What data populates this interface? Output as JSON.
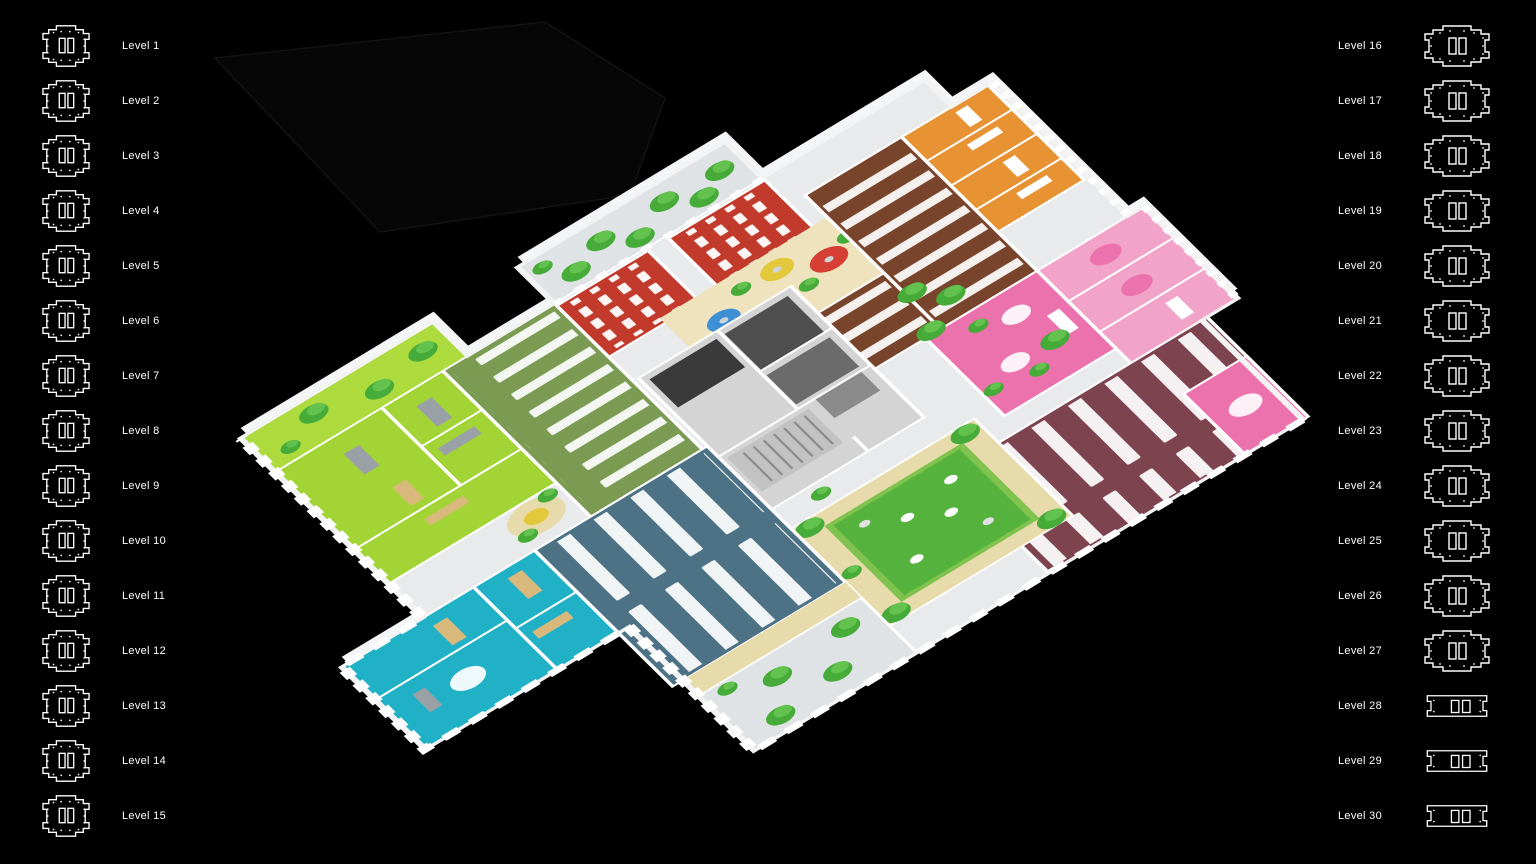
{
  "app": {
    "background": "#000000",
    "view": "3d-isometric-floorplan"
  },
  "sidebar_left": {
    "items": [
      {
        "label": "Level 1",
        "icon_variant": "octagon-a"
      },
      {
        "label": "Level 2",
        "icon_variant": "octagon-a"
      },
      {
        "label": "Level 3",
        "icon_variant": "octagon-a"
      },
      {
        "label": "Level 4",
        "icon_variant": "octagon-a"
      },
      {
        "label": "Level 5",
        "icon_variant": "octagon-a"
      },
      {
        "label": "Level 6",
        "icon_variant": "octagon-a"
      },
      {
        "label": "Level 7",
        "icon_variant": "octagon-a"
      },
      {
        "label": "Level 8",
        "icon_variant": "octagon-a"
      },
      {
        "label": "Level 9",
        "icon_variant": "octagon-a"
      },
      {
        "label": "Level 10",
        "icon_variant": "octagon-a"
      },
      {
        "label": "Level 11",
        "icon_variant": "octagon-a"
      },
      {
        "label": "Level 12",
        "icon_variant": "octagon-a"
      },
      {
        "label": "Level 13",
        "icon_variant": "octagon-a"
      },
      {
        "label": "Level 14",
        "icon_variant": "octagon-a"
      },
      {
        "label": "Level 15",
        "icon_variant": "octagon-a"
      }
    ]
  },
  "sidebar_right": {
    "items": [
      {
        "label": "Level 16",
        "icon_variant": "octagon-b"
      },
      {
        "label": "Level 17",
        "icon_variant": "octagon-b"
      },
      {
        "label": "Level 18",
        "icon_variant": "octagon-b"
      },
      {
        "label": "Level 19",
        "icon_variant": "octagon-b"
      },
      {
        "label": "Level 20",
        "icon_variant": "octagon-b"
      },
      {
        "label": "Level 21",
        "icon_variant": "octagon-b"
      },
      {
        "label": "Level 22",
        "icon_variant": "octagon-b"
      },
      {
        "label": "Level 23",
        "icon_variant": "octagon-b"
      },
      {
        "label": "Level 24",
        "icon_variant": "octagon-b"
      },
      {
        "label": "Level 25",
        "icon_variant": "octagon-b"
      },
      {
        "label": "Level 26",
        "icon_variant": "octagon-b"
      },
      {
        "label": "Level 27",
        "icon_variant": "octagon-b"
      },
      {
        "label": "Level 28",
        "icon_variant": "slab"
      },
      {
        "label": "Level 29",
        "icon_variant": "slab"
      },
      {
        "label": "Level 30",
        "icon_variant": "slab"
      }
    ]
  },
  "floorplan": {
    "description": "3D isometric cutaway of one office level with colour-coded zones, desks, trees and central courtyard",
    "zones": [
      {
        "name": "terrace-garden-northwest",
        "color_key": "marble"
      },
      {
        "name": "auditorium-red-a",
        "color_key": "red"
      },
      {
        "name": "auditorium-red-b",
        "color_key": "red"
      },
      {
        "name": "cafe-lounge-rugs",
        "color_key": "wood_light"
      },
      {
        "name": "meeting-rooms-orange",
        "color_key": "orange"
      },
      {
        "name": "open-office-brown",
        "color_key": "brown"
      },
      {
        "name": "meeting-rooms-pink",
        "color_key": "pink_light"
      },
      {
        "name": "breakout-pink",
        "color_key": "pink"
      },
      {
        "name": "open-office-maroon",
        "color_key": "maroon"
      },
      {
        "name": "services-core",
        "color_key": "core"
      },
      {
        "name": "courtyard-lawn",
        "color_key": "lawn"
      },
      {
        "name": "open-office-slate-blue",
        "color_key": "slate_blue"
      },
      {
        "name": "meeting-rooms-teal",
        "color_key": "cyan"
      },
      {
        "name": "open-office-olive",
        "color_key": "olive"
      },
      {
        "name": "open-office-lime",
        "color_key": "lime"
      },
      {
        "name": "terrace-lime-west",
        "color_key": "lime_bright"
      },
      {
        "name": "terrace-marble-south",
        "color_key": "marble"
      }
    ],
    "colors": {
      "background": "#000000",
      "label_text": "#ffffff",
      "icon_outline": "#ffffff",
      "slab": "#e8eaec",
      "slab_edge": "#f4f5f6",
      "marble": "#dfe3e6",
      "wood": "#e7daab",
      "wood_light": "#eee3bc",
      "wood_desk": "#d9b87c",
      "red": "#c23a2c",
      "orange": "#e79233",
      "brown": "#79442c",
      "pink_light": "#f2a3c8",
      "pink": "#eb72ad",
      "maroon": "#7d4450",
      "core": "#d4d4d4",
      "room_dark": "#4f4f4f",
      "room_mid": "#6b6b6b",
      "room_darker": "#3a3a3a",
      "elevator": "#8a8a8a",
      "stairs": "#c2c2c2",
      "lawn": "#55b23d",
      "hedge": "#7fc24d",
      "tree": "#46ab39",
      "tree_light": "#63c24e",
      "slate_blue": "#4d7286",
      "cyan": "#21b1c7",
      "olive": "#7b9b52",
      "lime": "#a3d435",
      "lime_bright": "#adda3d",
      "rug_red": "#d64034",
      "rug_green": "#6fbe44",
      "rug_blue": "#3f8fd6",
      "rug_yellow": "#e3c83c",
      "desk": "#ffffff",
      "sofa": "#9aa1a6",
      "wall": "#ffffff",
      "ghost": "#131313"
    }
  }
}
